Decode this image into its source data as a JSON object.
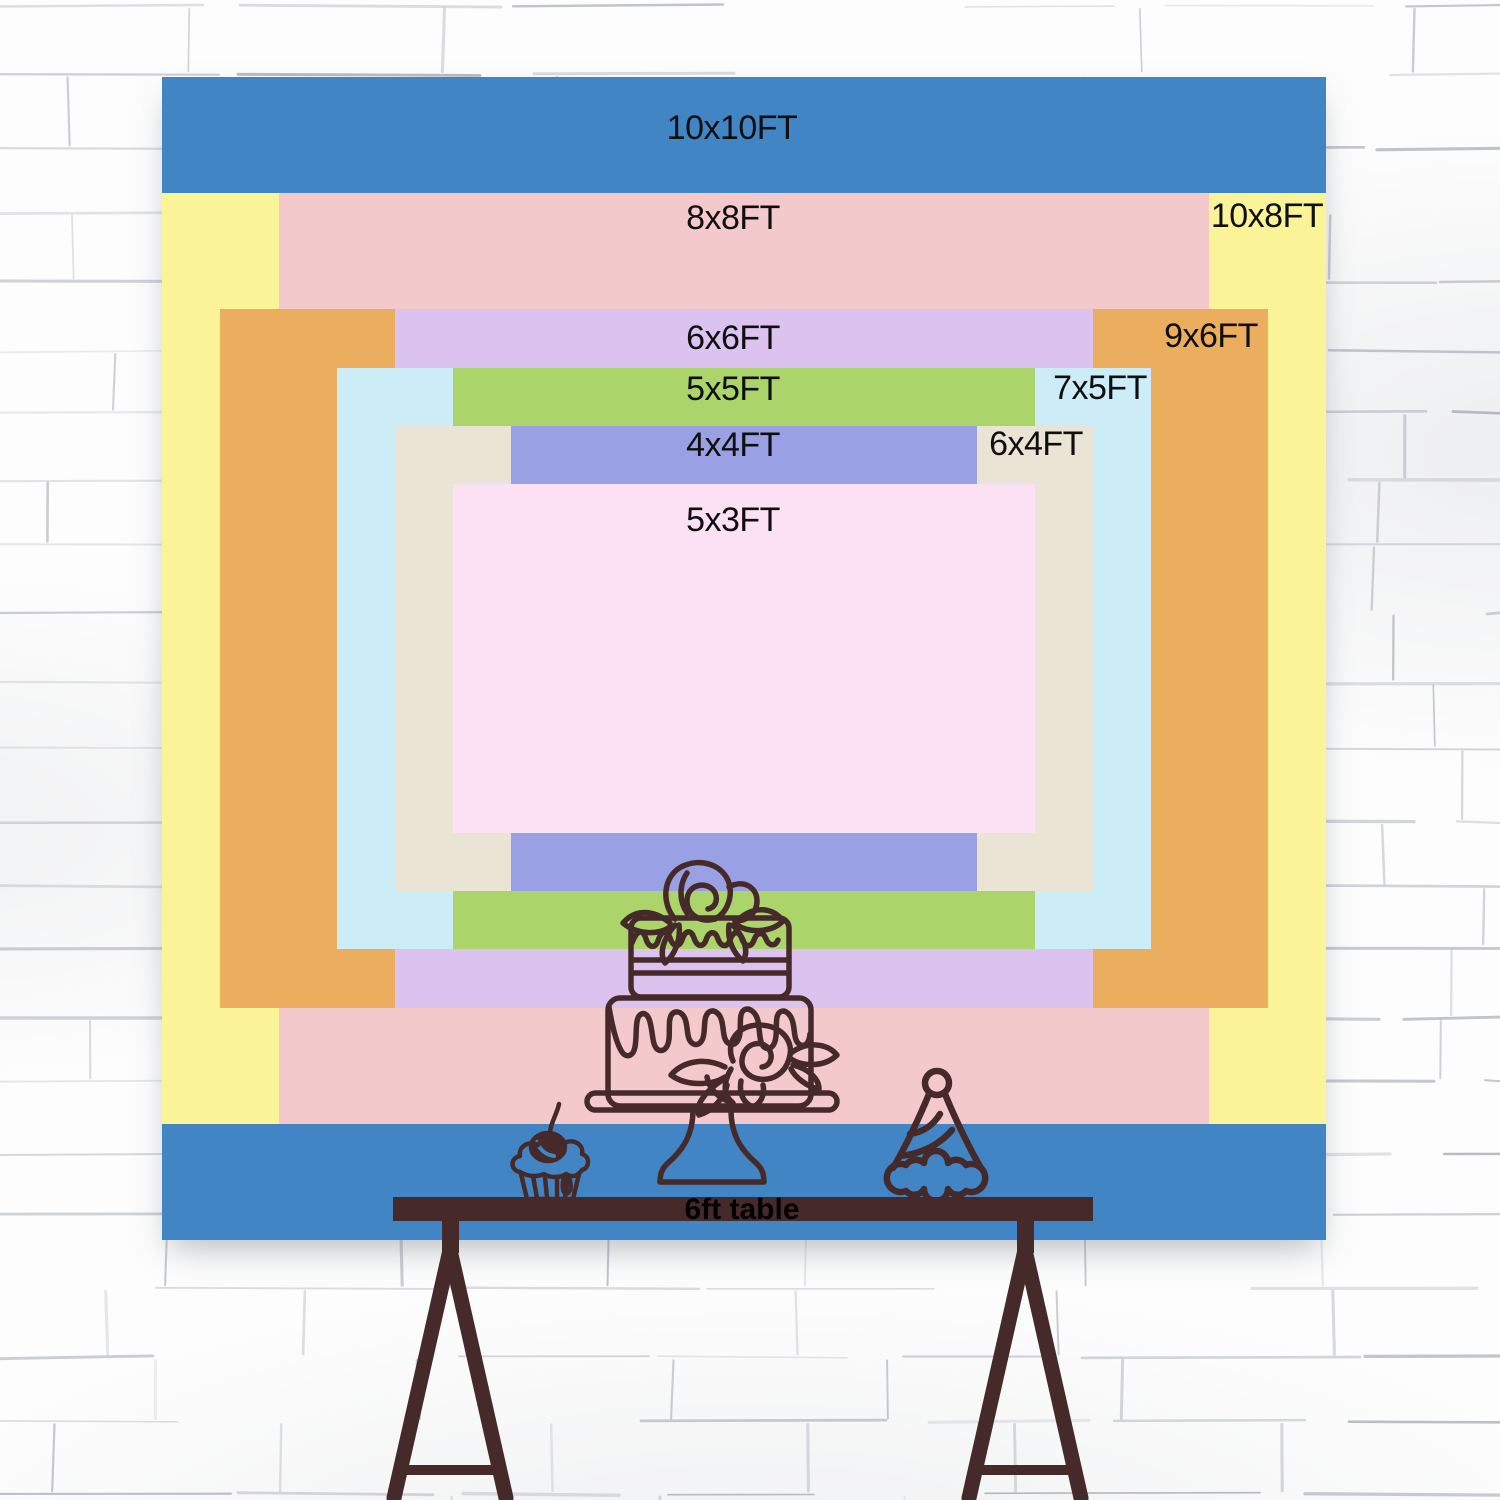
{
  "backdrop_chart": {
    "unit": "FT",
    "sizes": [
      {
        "id": "10x10",
        "label": "10x10FT",
        "width_ft": 10,
        "height_ft": 10,
        "color": "#4285C4",
        "label_placement": "top-center"
      },
      {
        "id": "10x8",
        "label": "10x8FT",
        "width_ft": 10,
        "height_ft": 8,
        "color": "#FAF398",
        "label_placement": "right-column"
      },
      {
        "id": "8x8",
        "label": "8x8FT",
        "width_ft": 8,
        "height_ft": 8,
        "color": "#F4C9CB",
        "label_placement": "top-center"
      },
      {
        "id": "9x6",
        "label": "9x6FT",
        "width_ft": 9,
        "height_ft": 6,
        "color": "#EBAD5E",
        "label_placement": "right-column"
      },
      {
        "id": "6x6",
        "label": "6x6FT",
        "width_ft": 6,
        "height_ft": 6,
        "color": "#DCC3EF",
        "label_placement": "top-center"
      },
      {
        "id": "7x5",
        "label": "7x5FT",
        "width_ft": 7,
        "height_ft": 5,
        "color": "#CCECF8",
        "label_placement": "right-column"
      },
      {
        "id": "5x5",
        "label": "5x5FT",
        "width_ft": 5,
        "height_ft": 5,
        "color": "#ABD56B",
        "label_placement": "top-center"
      },
      {
        "id": "6x4",
        "label": "6x4FT",
        "width_ft": 6,
        "height_ft": 4,
        "color": "#E9E4D3",
        "label_placement": "right-column"
      },
      {
        "id": "4x4",
        "label": "4x4FT",
        "width_ft": 4,
        "height_ft": 4,
        "color": "#9AA0E4",
        "label_placement": "top-center"
      },
      {
        "id": "5x3",
        "label": "5x3FT",
        "width_ft": 5,
        "height_ft": 3,
        "color": "#FCE0F3",
        "label_placement": "top-center"
      }
    ]
  },
  "table": {
    "label": "6ft table"
  },
  "palette": {
    "line_art": "#462A2A",
    "label_text": "#0F0F0F",
    "wall": "#FDFDFD",
    "mortar": "#7E8695"
  },
  "decorations": [
    {
      "icon": "tiered-cake-icon"
    },
    {
      "icon": "cupcake-icon"
    },
    {
      "icon": "party-hat-icon"
    },
    {
      "icon": "trestle-table-icon"
    }
  ]
}
